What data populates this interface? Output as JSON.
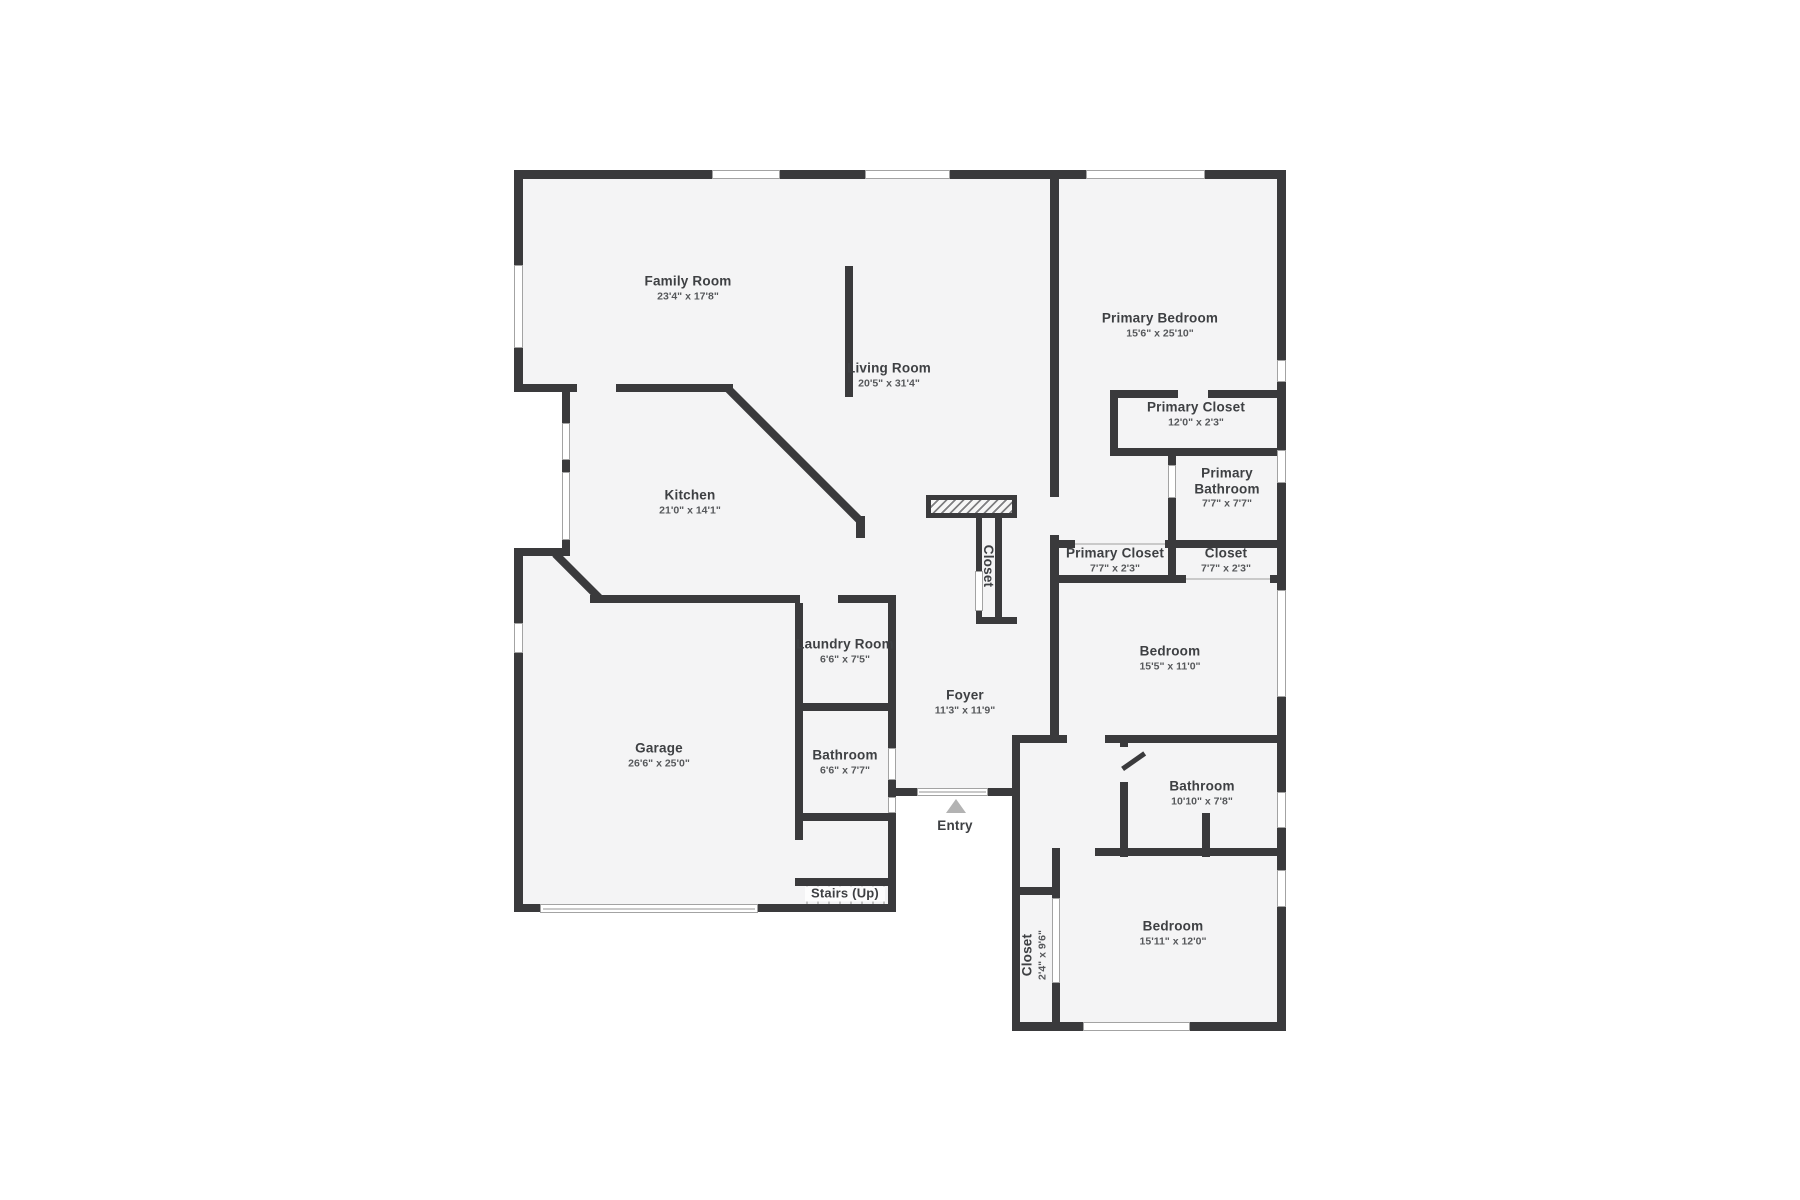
{
  "colors": {
    "page_background": "#ffffff",
    "floor_fill": "#f4f4f5",
    "wall": "#3a3a3c",
    "room_label": "#3e4043",
    "dimension_label": "#56585b",
    "window_frame": "#a3a3a3",
    "entry_arrow": "#b3b3b3"
  },
  "rooms": {
    "family_room": {
      "name": "Family Room",
      "dims": "23'4\" x 17'8\""
    },
    "living_room": {
      "name": "Living Room",
      "dims": "20'5\" x 31'4\""
    },
    "kitchen": {
      "name": "Kitchen",
      "dims": "21'0\" x 14'1\""
    },
    "primary_bedroom": {
      "name": "Primary Bedroom",
      "dims": "15'6\" x 25'10\""
    },
    "primary_closet_top": {
      "name": "Primary Closet",
      "dims": "12'0\" x 2'3\""
    },
    "primary_bathroom": {
      "name": "Primary",
      "name2": "Bathroom",
      "dims": "7'7\" x 7'7\""
    },
    "primary_closet_small": {
      "name": "Primary Closet",
      "dims": "7'7\" x 2'3\""
    },
    "closet_small": {
      "name": "Closet",
      "dims": "7'7\" x 2'3\""
    },
    "bedroom_mid": {
      "name": "Bedroom",
      "dims": "15'5\" x 11'0\""
    },
    "laundry_room": {
      "name": "Laundry Room",
      "dims": "6'6\" x 7'5\""
    },
    "foyer": {
      "name": "Foyer",
      "dims": "11'3\" x 11'9\""
    },
    "garage": {
      "name": "Garage",
      "dims": "26'6\" x 25'0\""
    },
    "bathroom_hall": {
      "name": "Bathroom",
      "dims": "6'6\" x 7'7\""
    },
    "bathroom_right": {
      "name": "Bathroom",
      "dims": "10'10\" x 7'8\""
    },
    "bedroom_bottom": {
      "name": "Bedroom",
      "dims": "15'11\" x 12'0\""
    },
    "closet_center": {
      "name": "Closet"
    },
    "closet_bottom": {
      "name": "Closet",
      "dims": "2'4\" x 9'6\""
    },
    "entry": {
      "name": "Entry"
    },
    "stairs": {
      "name": "Stairs (Up)"
    }
  }
}
